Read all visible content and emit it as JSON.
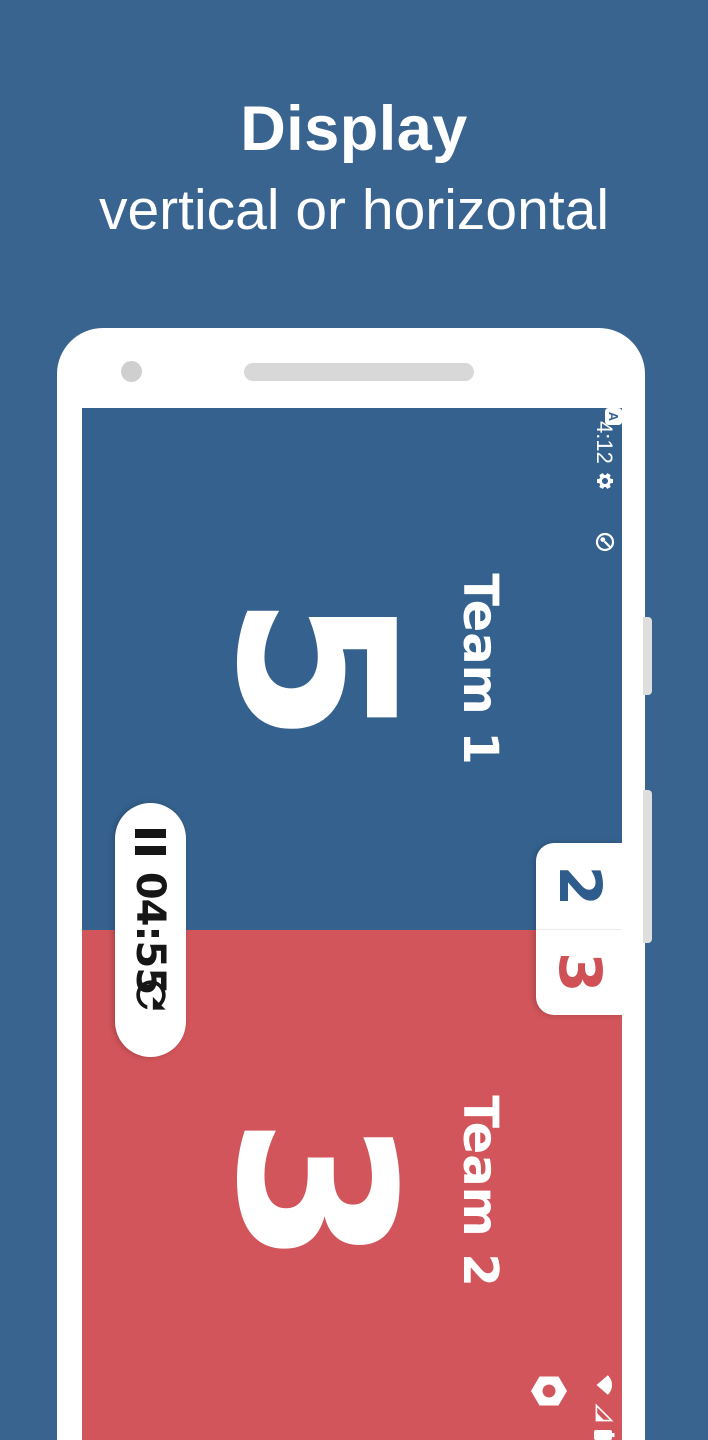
{
  "header": {
    "title": "Display",
    "subtitle": "vertical or horizontal"
  },
  "phone": {
    "status_bar": {
      "time": "4:12",
      "a_badge": "A",
      "notification_icons": [
        "settings-gear-icon",
        "letter-a-badge-icon",
        "data-saver-icon"
      ],
      "system_icons": [
        "wifi-icon",
        "cell-signal-icon",
        "battery-icon"
      ]
    },
    "scoreboard": {
      "orientation": "landscape-rotated-90deg",
      "teams": [
        {
          "name": "Team 1",
          "score": "5",
          "sets": "2",
          "color": "#35618E"
        },
        {
          "name": "Team 2",
          "score": "3",
          "sets": "3",
          "color": "#D1555A"
        }
      ],
      "timer": {
        "value": "04:55",
        "icons": [
          "pause-icon",
          "reset-icon"
        ]
      },
      "settings_icon": "hexagon-gear-icon"
    }
  },
  "colors": {
    "background": "#3A6490",
    "team1": "#35618E",
    "team2": "#D1555A",
    "sets_team1_text": "#2E5C8C",
    "sets_team2_text": "#CF5156"
  }
}
